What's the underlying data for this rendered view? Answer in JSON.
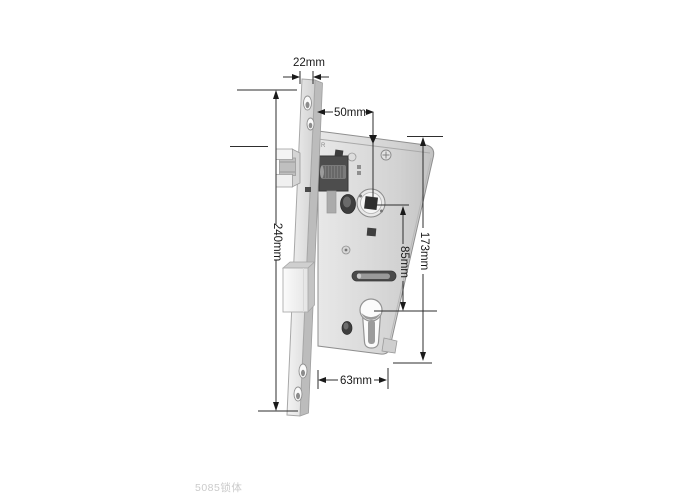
{
  "diagram": {
    "title_hint": "mortise lock body dimension drawing",
    "dimensions": {
      "faceplate_width": "22mm",
      "backset": "50mm",
      "faceplate_length": "240mm",
      "case_height": "173mm",
      "hub_to_cylinder": "85mm",
      "case_depth": "63mm"
    },
    "stamp": "R",
    "colors": {
      "background": "#ffffff",
      "dimension_line": "#2e2e2e",
      "metal_light": "#f0f0f0",
      "metal_mid": "#c9c9c9",
      "metal_dark": "#4d4d4d",
      "watermark": "#cbcbcb"
    }
  },
  "watermark": {
    "label": "5085锁体"
  }
}
